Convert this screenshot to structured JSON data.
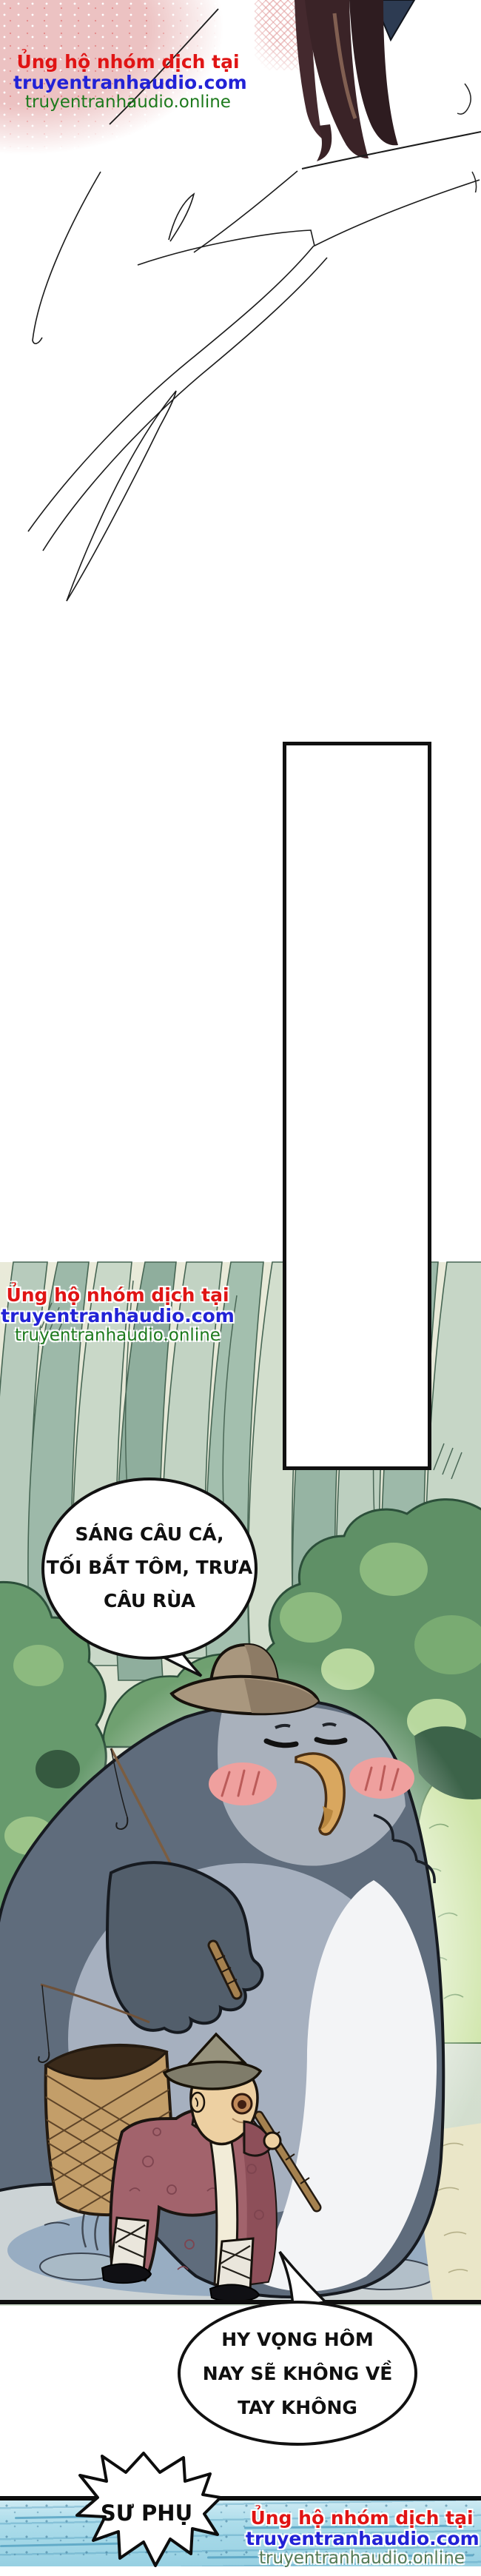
{
  "page": {
    "kind": "translated webtoon comic page",
    "language": "Vietnamese"
  },
  "watermark": {
    "line1": "Ủng hộ nhóm dịch tại",
    "line2": "truyentranhaudio.com",
    "line3": "truyentranhaudio.online"
  },
  "speech": {
    "bubble1": {
      "lines": [
        "SÁNG CÂU CÁ,",
        "TỐI BẮT TÔM, TRƯA",
        "CÂU RÙA"
      ]
    },
    "bubble2": {
      "lines": [
        "HY VỌNG HÔM",
        "NAY SẼ KHÔNG VỀ",
        "TAY KHÔNG"
      ]
    },
    "shout": {
      "text": "SƯ PHỤ"
    }
  },
  "colors": {
    "watermark_red": "#e01414",
    "watermark_blue": "#2222d6",
    "watermark_green": "#1d7a1d",
    "pink_blossom": "#ecc2c2",
    "forest_leaf": "#9db9a9",
    "bush_green": "#5f9066",
    "bird_back_slate": "#5f6c7c",
    "bird_face_grey": "#a9b1bc",
    "bird_belly_white": "#f3f4f6",
    "hat_tan": "#a9977e",
    "beak_gold": "#d9a75f",
    "blush_pink": "#efa09e",
    "robe_maroon": "#a2636c",
    "basket_tan": "#c39e69",
    "ground_grey": "#ccd3d5",
    "water_blue": "#a9dcea",
    "panel_border": "#101010"
  }
}
